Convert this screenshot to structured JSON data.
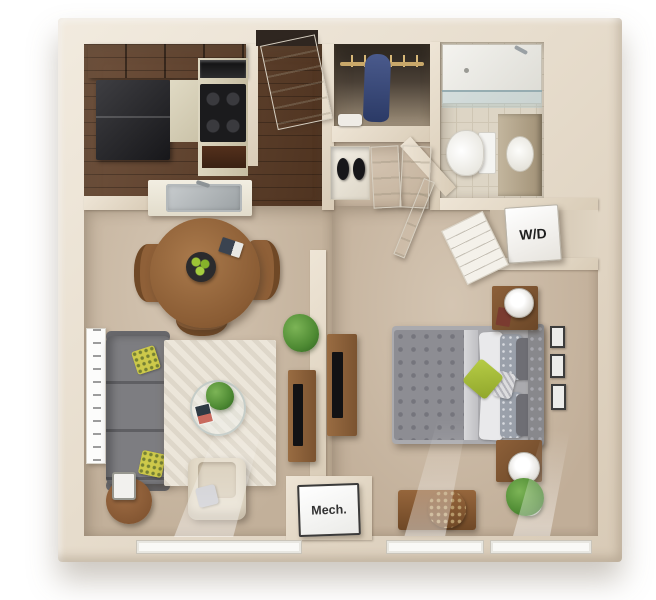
{
  "floorplan": {
    "labels": {
      "washer_dryer": "W/D",
      "mechanical": "Mech."
    },
    "colors": {
      "background": "#ffffff",
      "wall_cream": "#e8dfd0",
      "wood_floor": "#5e3d26",
      "carpet": "#c9b8a4",
      "bathroom_tile": "#ddd5c5",
      "rug": "#ece6da",
      "sofa_gray": "#7d7d81",
      "bedding_gray": "#8d8d93",
      "accent_pillow_green": "#a9c03c",
      "furniture_wood": "#8a5c36",
      "appliance_black": "#1b1b1d",
      "plant_green": "#4e8a33",
      "label_text": "#1f1f1f"
    },
    "rooms": [
      "kitchen",
      "entry",
      "wardrobe-closet",
      "bathroom",
      "hallway",
      "living-dining-room",
      "bedroom",
      "washer-dryer-closet",
      "mechanical-closet"
    ]
  }
}
